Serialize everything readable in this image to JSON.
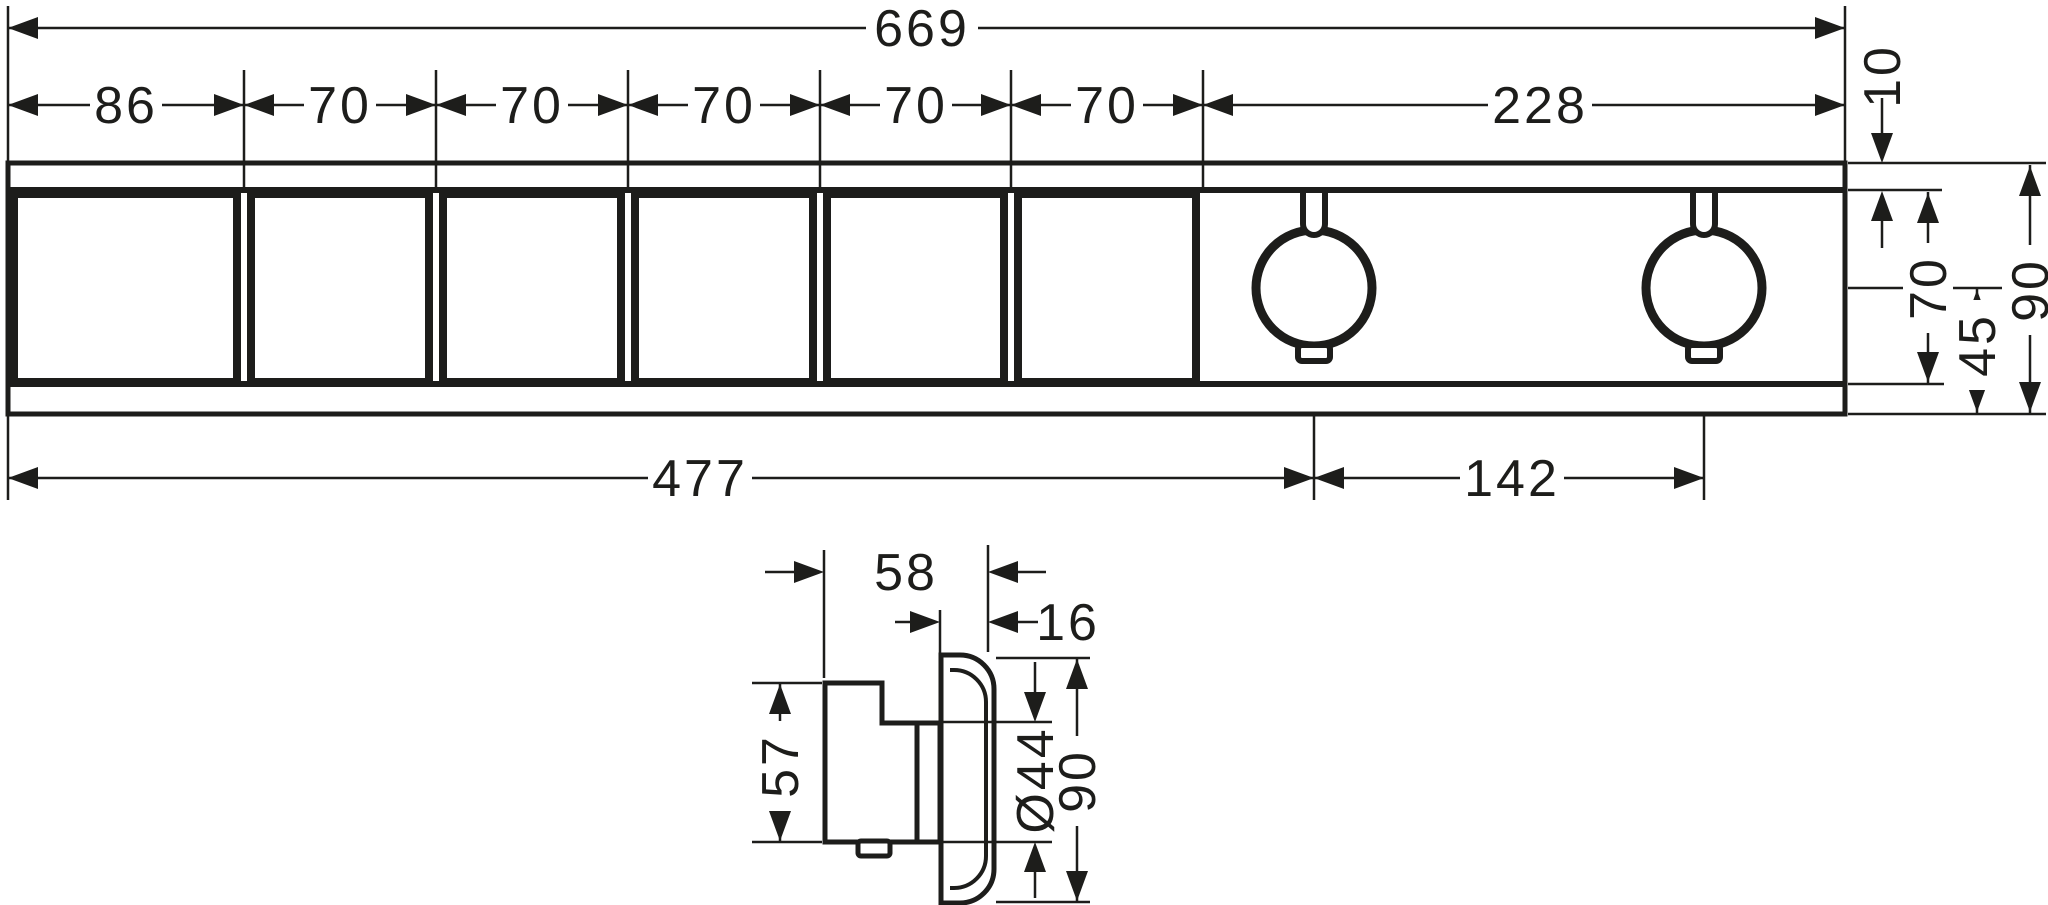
{
  "drawing": {
    "line_color": "#1d1d1b",
    "background": "#ffffff",
    "front_view": {
      "overall_width": "669",
      "segments": [
        "86",
        "70",
        "70",
        "70",
        "70",
        "70",
        "228"
      ],
      "top_strip": "10",
      "body_height": "70",
      "total_height": "90",
      "knob_center_to_bottom": "45",
      "left_to_knob1": "477",
      "knob_spacing": "142"
    },
    "side_view": {
      "projection": "58",
      "plate_thickness": "16",
      "handle_height": "57",
      "knob_diameter": "Ø44",
      "plate_height": "90"
    }
  }
}
